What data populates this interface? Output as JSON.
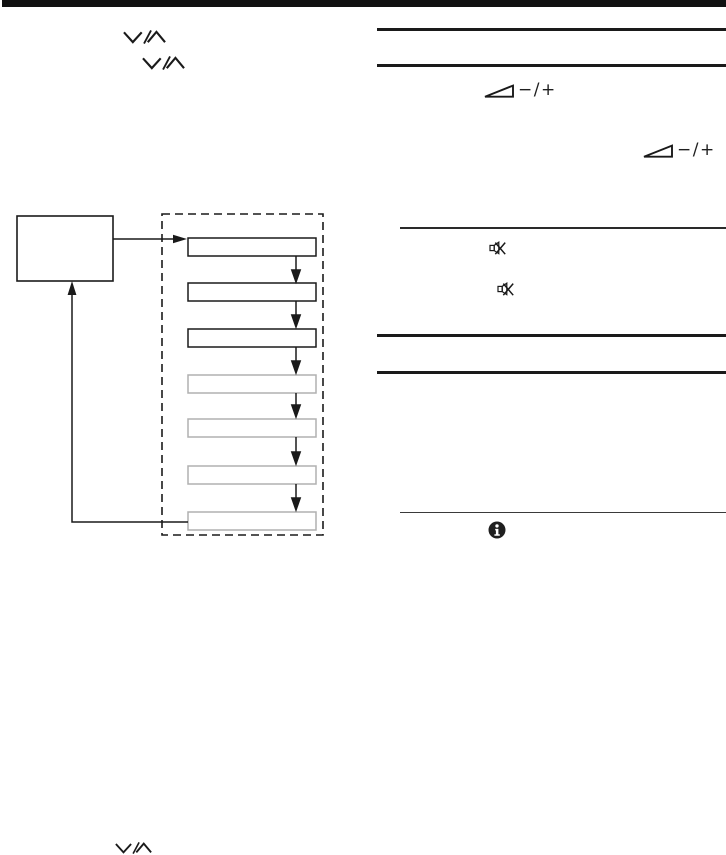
{
  "page": {
    "kind": "instruction-manual-diagram-page",
    "background_color": "#ffffff",
    "ink_color": "#1a1a1a",
    "muted_outline_color": "#b0b0b0",
    "header_bar_color": "#111111"
  },
  "labels": {
    "volume_adjust": "−/+"
  },
  "icons": {
    "top_channel_icons": [
      "channel-up-down-icon",
      "channel-up-down-icon"
    ],
    "volume_icons": [
      "volume-wedge-icon",
      "volume-wedge-icon"
    ],
    "muting_icons": [
      "muting-icon",
      "muting-icon"
    ],
    "info_icon": "info-icon",
    "bottom_channel_icon": "channel-up-down-icon"
  },
  "flowchart": {
    "source_box": "source-box",
    "steps": [
      {
        "outline": "solid-black"
      },
      {
        "outline": "solid-black"
      },
      {
        "outline": "solid-black"
      },
      {
        "outline": "muted-gray"
      },
      {
        "outline": "muted-gray"
      },
      {
        "outline": "muted-gray"
      },
      {
        "outline": "muted-gray"
      }
    ],
    "flow": "source-box-feeds-step-1, steps cascade downward, last step loops back to source-box"
  },
  "right_column": {
    "section_rules": 6
  }
}
